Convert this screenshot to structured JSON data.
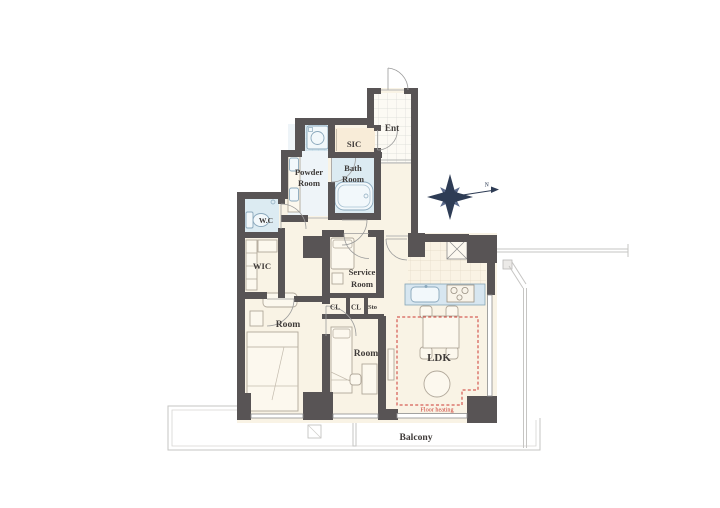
{
  "document": {
    "type": "apartment-floor-plan"
  },
  "labels": {
    "ent": "Ent",
    "sic": "SIC",
    "powder": [
      "Powder",
      "Room"
    ],
    "bath": [
      "Bath",
      "Room"
    ],
    "wc": "W.C",
    "wic": "WIC",
    "service": [
      "Service",
      "Room"
    ],
    "cl1": "CL",
    "cl2": "CL",
    "sto": "Sto",
    "room_left": "Room",
    "room_center": "Room",
    "ldk": "LDK",
    "balcony": "Balcony",
    "floor_heating": "Floor heating",
    "compass_north": "N"
  },
  "colors": {
    "wall": "#585455",
    "floor_cream": "#f9f3e5",
    "floor_sic": "#f8ecd8",
    "floor_wet": "#dcebf2",
    "floor_powder": "#eef4f8",
    "counter_blue": "#d7e6f0",
    "accent_red": "#cd3a32",
    "compass": "#2e3c55",
    "text": "#3f3b39"
  },
  "icons": {
    "compass-rose-icon": "eight-point-star",
    "north-arrow-icon": "arrow-right",
    "bathtub-icon": "rounded-rect",
    "toilet-icon": "tank-and-bowl",
    "washing-machine-icon": "square-with-drum",
    "vanity-basin-icon": "twin-basins",
    "kitchen-sink-icon": "rounded-basin",
    "stove-icon": "three-burners",
    "shaft-x-icon": "box-with-x",
    "double-bed-icon": "bed",
    "single-bed-icon": "bed",
    "dining-table-icon": "table-four-chairs",
    "round-table-icon": "circle",
    "door-swing-arc": "quarter-circle",
    "floor-heating-boundary": "dashed-rect"
  }
}
